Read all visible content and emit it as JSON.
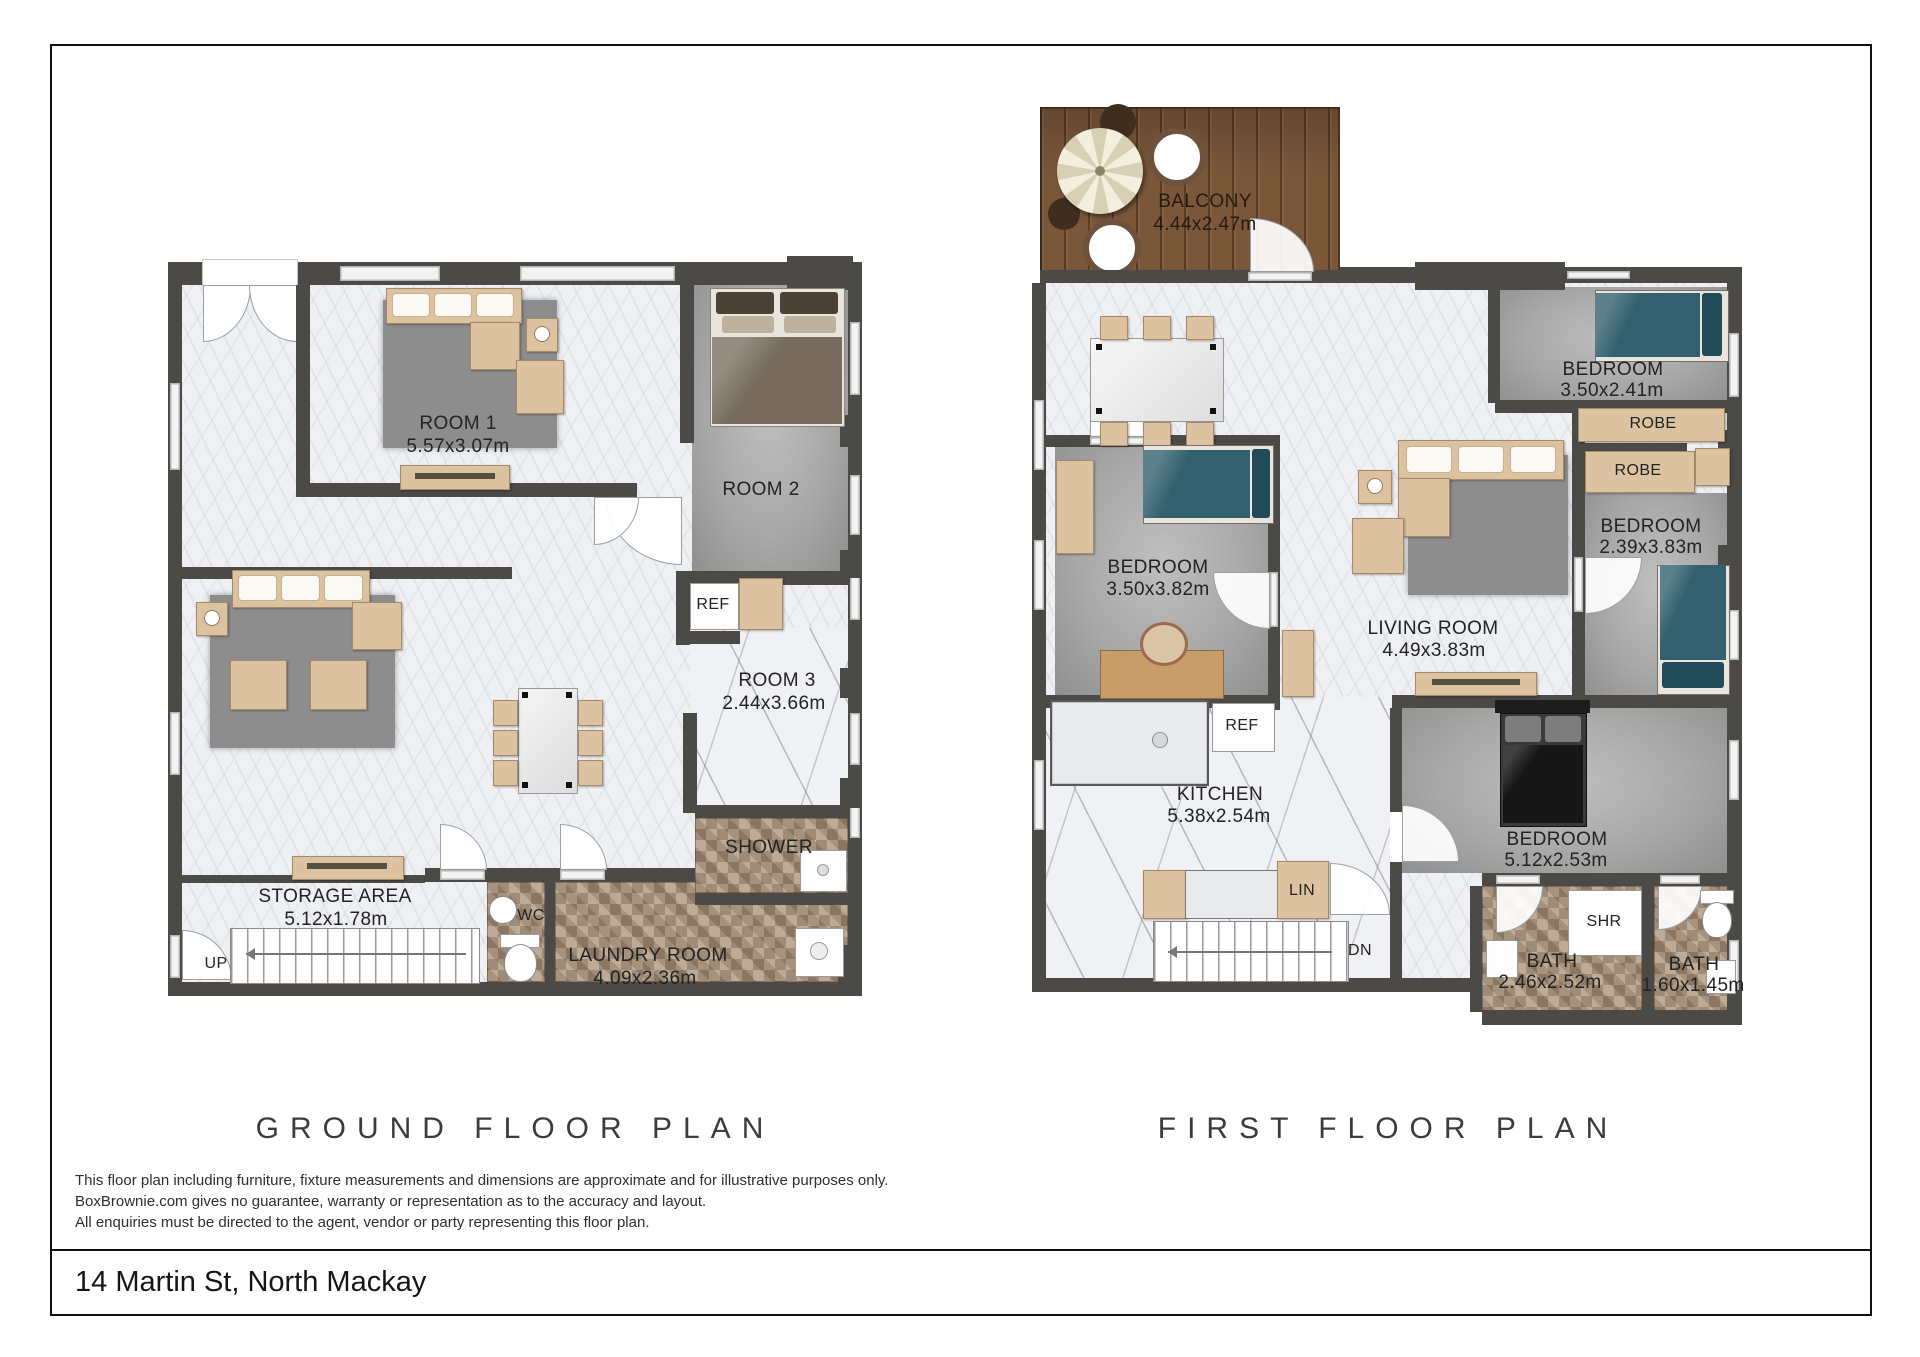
{
  "ground": {
    "title": "GROUND FLOOR PLAN",
    "room1": {
      "name": "ROOM 1",
      "dims": "5.57x3.07m"
    },
    "room2": {
      "name": "ROOM 2"
    },
    "room3": {
      "name": "ROOM 3",
      "dims": "2.44x3.66m"
    },
    "storage": {
      "name": "STORAGE AREA",
      "dims": "5.12x1.78m"
    },
    "laundry": {
      "name": "LAUNDRY ROOM",
      "dims": "4.09x2.36m"
    },
    "shower": "SHOWER",
    "wc": "WC",
    "ref": "REF",
    "up": "UP"
  },
  "first": {
    "title": "FIRST FLOOR PLAN",
    "balcony": {
      "name": "BALCONY",
      "dims": "4.44x2.47m"
    },
    "bedroom_top": {
      "name": "BEDROOM",
      "dims": "3.50x2.41m"
    },
    "robe1": "ROBE",
    "robe2": "ROBE",
    "bedroom_right": {
      "name": "BEDROOM",
      "dims": "2.39x3.83m"
    },
    "bedroom_left": {
      "name": "BEDROOM",
      "dims": "3.50x3.82m"
    },
    "living": {
      "name": "LIVING ROOM",
      "dims": "4.49x3.83m"
    },
    "kitchen": {
      "name": "KITCHEN",
      "dims": "5.38x2.54m"
    },
    "bedroom_bottom": {
      "name": "BEDROOM",
      "dims": "5.12x2.53m"
    },
    "bath1": {
      "name": "BATH",
      "dims": "2.46x2.52m"
    },
    "bath2": {
      "name": "BATH",
      "dims": "1.60x1.45m"
    },
    "shr": "SHR",
    "lin": "LIN",
    "dn": "DN",
    "ref": "REF"
  },
  "footer": {
    "disclaimer_line1": "This floor plan including furniture, fixture measurements and dimensions are approximate and for illustrative purposes only.",
    "disclaimer_line2": "BoxBrownie.com gives no guarantee, warranty or representation as to the accuracy and layout.",
    "disclaimer_line3": "All enquiries must be directed to the agent, vendor or party representing this floor plan.",
    "address": "14 Martin St, North Mackay"
  },
  "colors": {
    "wall": "#4c4a47",
    "marble_floor": "#eef0f3",
    "carpet": "#a8a8a8",
    "rug": "#8d8d8d",
    "mosaic_tile": "#a08b76",
    "deck_wood": "#7b573a",
    "bed_teal": "#33606f",
    "furniture_beige": "#dcc2a0"
  }
}
